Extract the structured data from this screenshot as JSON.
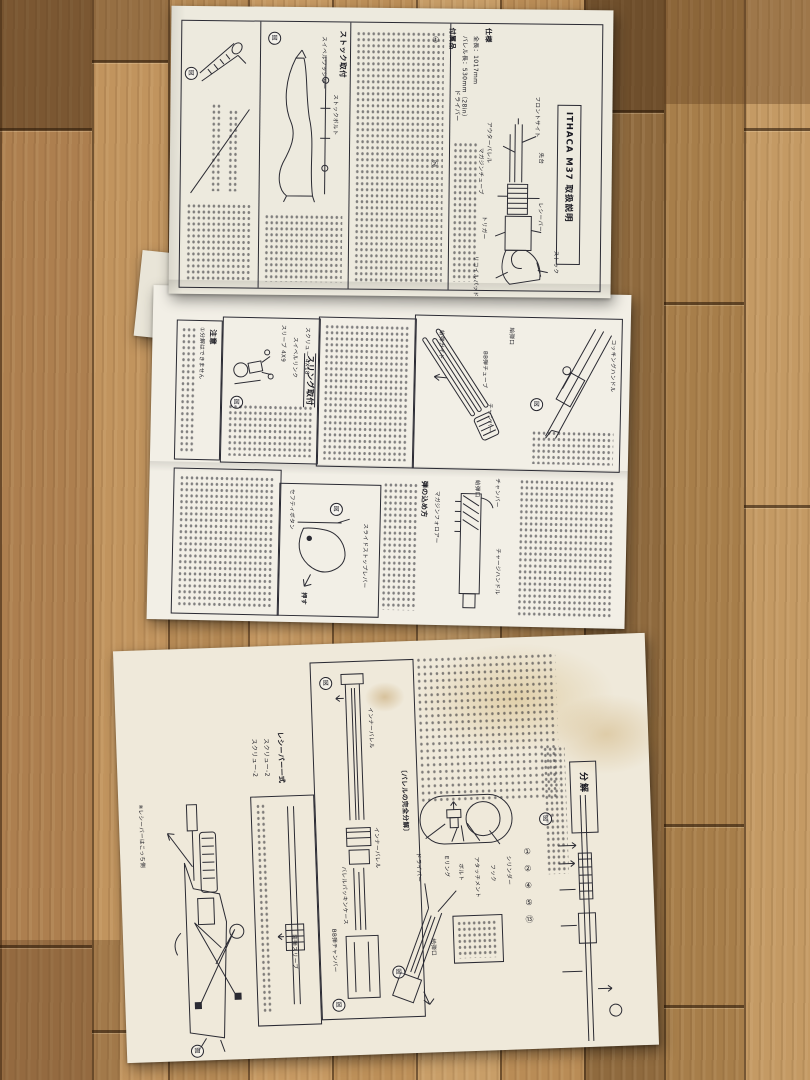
{
  "figure_marker": "図",
  "title": "ITHACA M37 取扱説明",
  "top_page": {
    "spec_heading": "仕様",
    "spec_lines": [
      "全長：1017mm",
      "バレル長：530mm（28in）"
    ],
    "accessories_heading": "付属品",
    "accessory_item": "ドライバー",
    "stock_heading": "ストック取付",
    "stock_bolt_label": "ストックボルト",
    "swivel_label": "スイベルワッシャー",
    "markers": [
      "①",
      "②"
    ],
    "gun_labels": [
      "フロントサイト",
      "アウターバレル",
      "先台",
      "マガジンチューブ",
      "レシーバー",
      "トリガー",
      "ストック",
      "リコイルパッド"
    ]
  },
  "middle_page": {
    "caution_heading": "注意",
    "caution_text": "①分解はできません",
    "sling_heading": "スリング取付",
    "sling_labels": [
      "スリーブ 4X9",
      "スイベルリンク",
      "スクリュー 4X18"
    ],
    "tube_labels": [
      "給弾口",
      "BB弾チューブ",
      "チャンバー",
      "給弾ガイド",
      "コッキングハンドル"
    ],
    "loading_heading": "弾の込め方",
    "trigger_labels": [
      "セフティボタン",
      "スライドストップレバー",
      "押す"
    ],
    "section_labels": [
      "給弾口",
      "チャンバー",
      "マガジンフォロアー",
      "チャージハンドル"
    ]
  },
  "bottom_page": {
    "disassembly_heading": "分解",
    "receiver_set_heading": "レシーバー一式",
    "receiver_set_items": [
      "スクリュー-2",
      "スクリュー-2"
    ],
    "receiver_note": "※レシーバーはこっち側",
    "barrel_caption": "〔バレルの完全分解〕",
    "barrel_labels": [
      "インナーバレル",
      "インナーバレル",
      "バレルパッキンケース",
      "BB弾チャンバー"
    ],
    "sleeve_label": "装弾スリーブ",
    "feed_port_label": "給弾口",
    "cylinder_labels": [
      "ドライバー",
      "Eリング",
      "ボルト",
      "アタッチメント",
      "フック",
      "シリンダー"
    ],
    "circled_numbers": [
      "①",
      "②",
      "④",
      "⑤",
      "⑬"
    ]
  }
}
